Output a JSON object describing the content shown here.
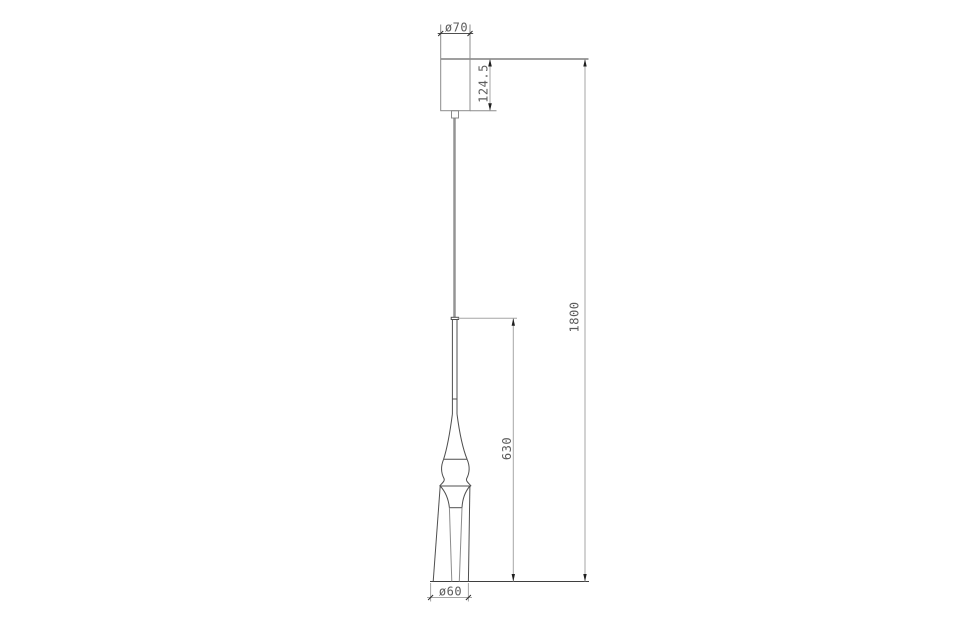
{
  "drawing": {
    "type": "pendant-lamp-technical-drawing",
    "dimensions": {
      "canopy_diameter": "ø70",
      "canopy_height": "124.5",
      "shade_height": "630",
      "overall_height": "1800",
      "shade_diameter": "ø60"
    },
    "colors": {
      "background": "#ffffff",
      "object_line": "#4f4f4f",
      "reference_line": "#3f3f3f",
      "dimension_line": "#a6a6a6",
      "arrow": "#1f1f1f",
      "text": "#5c5c5c"
    }
  }
}
